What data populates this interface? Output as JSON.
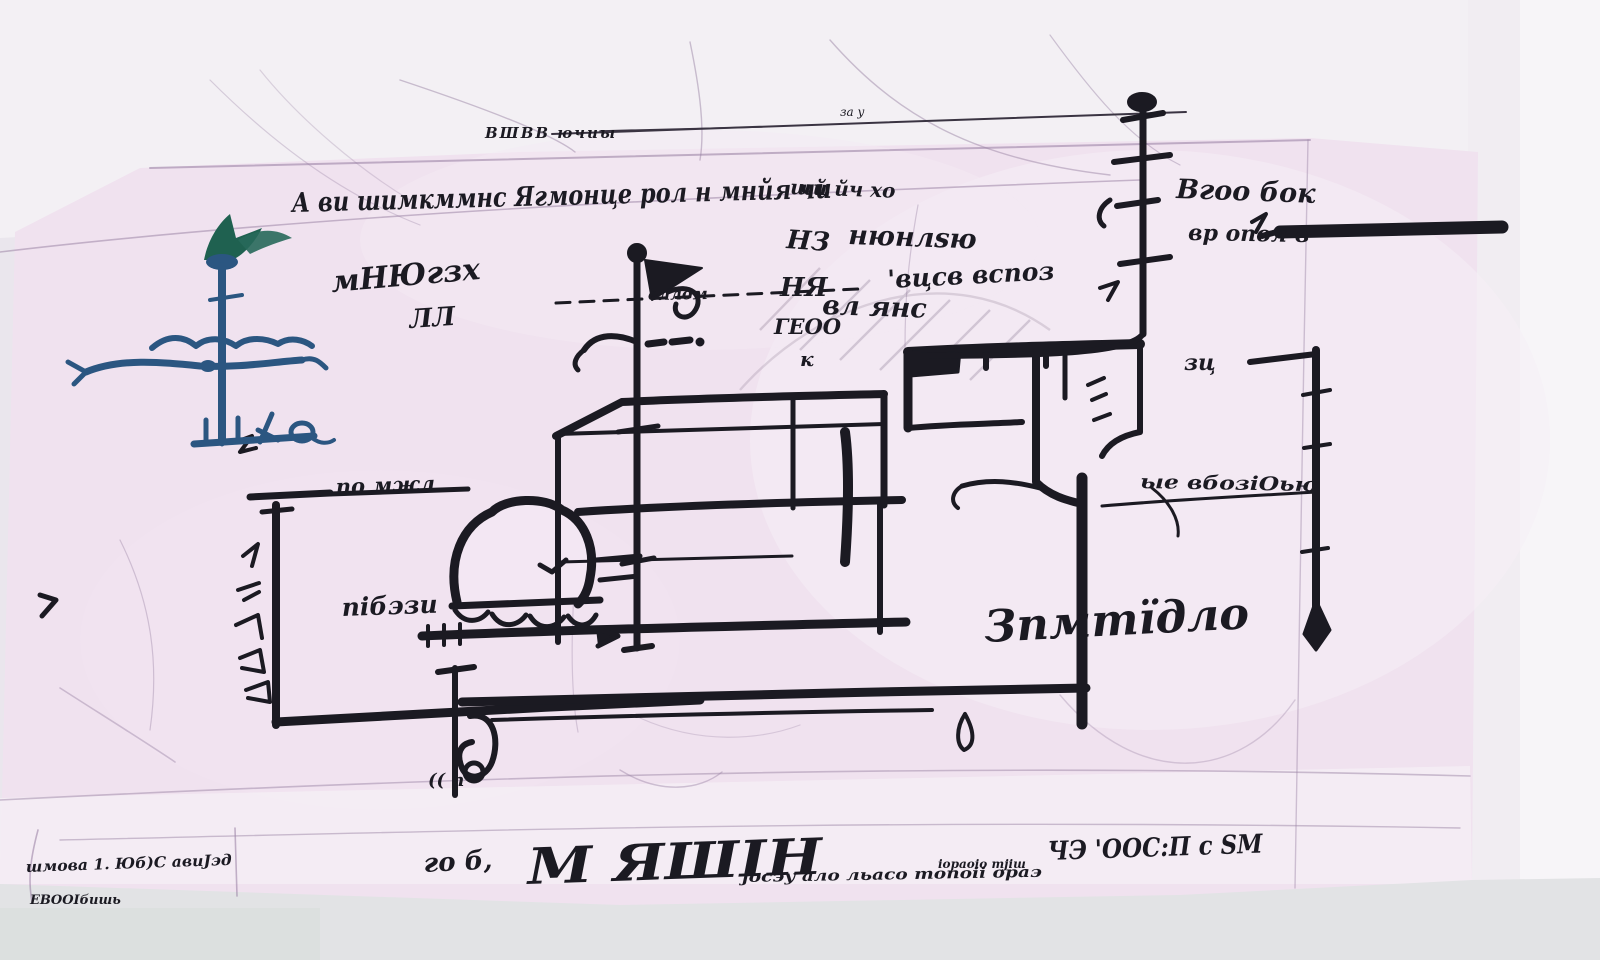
{
  "photo": {
    "description": "photograph of a hand-drawn site plan sketch in black ink on pink-tinted tracing paper",
    "colors": {
      "paper": "#f0e2ef",
      "ink": "#1b1a22",
      "compass_blue": "#2b5681",
      "compass_green": "#1f6150",
      "title_blue": "#3b5cb0",
      "navy": "#2c3766",
      "table": "#e2e3e5"
    }
  },
  "annotations": {
    "top_small": "ВШВВ ючиы",
    "top_tiny": "за у",
    "top_main": "А ви шимкммнс Ягмонце рол н мнйя чи",
    "label_left_a": "мНЮгзх",
    "label_left_b": "ЛЛ",
    "leader_text": "вллом",
    "mid_a": "щй йч хо",
    "mid_col_1": "НЗ",
    "mid_col_2": "НЯ",
    "mid_col_3": "ГЕОО",
    "mid_col_4": "к",
    "mid_b": "нюнлѕю",
    "mid_c": "'вцсв вспоз",
    "mid_d": "вл янс",
    "right_top_a": "Вгоо бок",
    "right_top_b": "вр опол в",
    "right_small": "зц",
    "right_mid": "ые вбозіОью",
    "enclosure_top": "по мжл",
    "enclosure_inner": "пібэзи",
    "big_word": "Зпмтїдло",
    "gate_marks": "(( п",
    "corner_line1": "шмова 1. Юб)С авиЈэд",
    "corner_line2": "ЕВООІбишь"
  },
  "title_block": {
    "prefix": "го б,",
    "title": "М ЯШІН",
    "note": "јосэу ало льасо топоіі ораэ",
    "sub_note": "іораоіо тјіш",
    "scale": "ЧЭ 'ООС:П с ЅМ"
  }
}
